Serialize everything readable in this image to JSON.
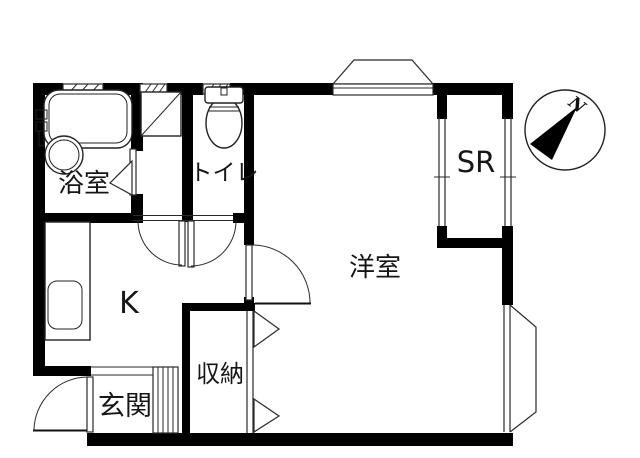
{
  "drawing": {
    "kind": "apartment-floor-plan",
    "background_color": "#ffffff",
    "wall_color": "#000000",
    "line_color": "#2a2a2a"
  },
  "rooms": {
    "bathroom": {
      "label": "浴室"
    },
    "toilet": {
      "label": "トイレ"
    },
    "kitchen": {
      "label": "K"
    },
    "western_room": {
      "label": "洋室"
    },
    "service_room": {
      "label": "SR"
    },
    "closet": {
      "label": "収納"
    },
    "entrance": {
      "label": "玄関"
    }
  },
  "compass": {
    "north_label": "N"
  },
  "fixtures": [
    "bathtub",
    "bath-faucet",
    "wash-basin",
    "washing-machine-pan",
    "toilet-bowl",
    "toilet-tank",
    "kitchen-counter",
    "kitchen-sink",
    "shoe-cabinet",
    "bay-window-top",
    "bay-window-right"
  ]
}
